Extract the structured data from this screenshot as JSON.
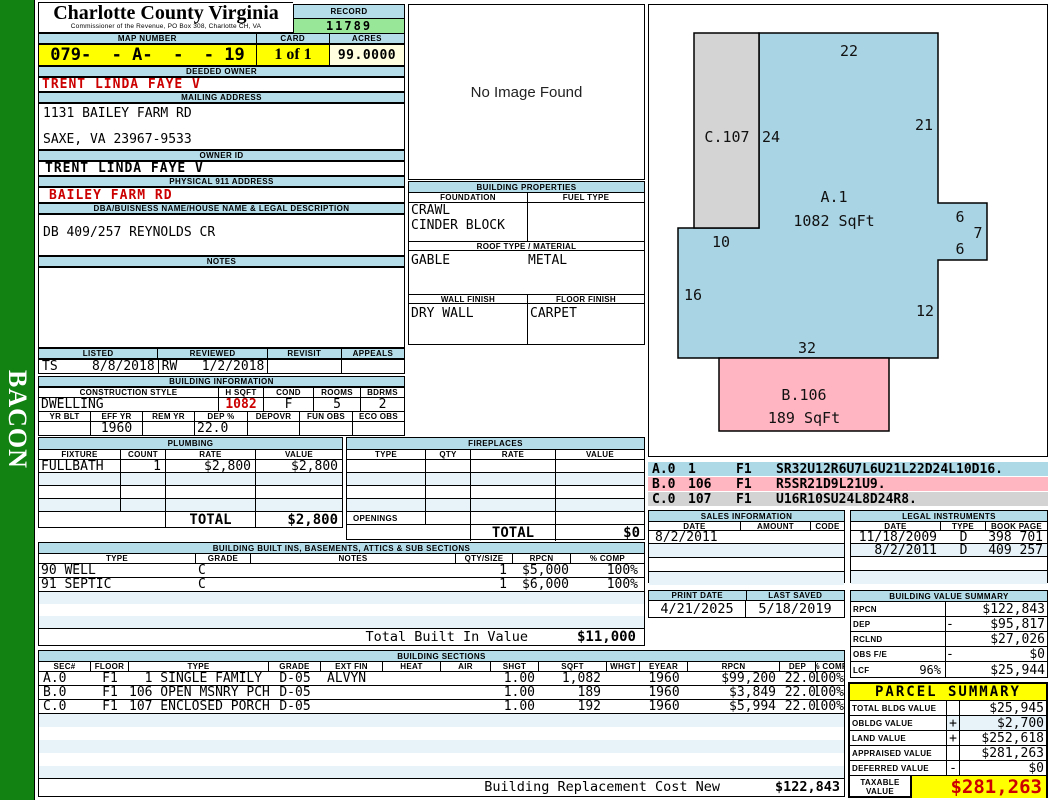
{
  "colors": {
    "header_bar": "#b5dde9",
    "highlight_yellow": "#ffff00",
    "record_green": "#98e798",
    "acres_cream": "#ffffe0",
    "alert_red": "#cc0000",
    "sidebar_green": "#128312",
    "sketch_blue": "#a9d4e4",
    "sketch_pink": "#ffb5c2",
    "sketch_gray": "#d4d4d4",
    "pale_row": "#e8f3f9"
  },
  "sidebar": {
    "label": "BACON"
  },
  "header": {
    "county": "Charlotte County Virginia",
    "subtitle": "Commissioner of the Revenue, PO Box 308, Charlotte CH, VA",
    "record_label": "RECORD",
    "record_number": "11789",
    "map_number_label": "MAP NUMBER",
    "map_number": "079-  - A-  -  - 19",
    "card_label": "CARD",
    "card": "1 of 1",
    "acres_label": "ACRES",
    "acres": "99.0000"
  },
  "owner": {
    "deeded_owner_label": "DEEDED OWNER",
    "deeded_owner": "TRENT LINDA FAYE V",
    "mailing_address_label": "MAILING ADDRESS",
    "mailing_line1": "1131 BAILEY FARM RD",
    "mailing_line2": "SAXE, VA 23967-9533",
    "owner_id_label": "OWNER ID",
    "owner_id": "TRENT LINDA FAYE V",
    "physical_label": "PHYSICAL 911 ADDRESS",
    "physical_address": "BAILEY FARM RD",
    "dba_label": "DBA/BUISNESS NAME/HOUSE NAME & LEGAL DESCRIPTION",
    "dba": "DB 409/257 REYNOLDS CR",
    "notes_label": "NOTES",
    "notes": ""
  },
  "review": {
    "listed_label": "LISTED",
    "listed_by": "TS",
    "listed_date": "8/8/2018",
    "reviewed_label": "REVIEWED",
    "reviewed_by": "RW",
    "reviewed_date": "1/2/2018",
    "revisit_label": "REVISIT",
    "revisit": "",
    "appeals_label": "APPEALS",
    "appeals": ""
  },
  "photo": {
    "placeholder": "No Image Found"
  },
  "building_properties": {
    "title": "BUILDING PROPERTIES",
    "foundation_label": "FOUNDATION",
    "fuel_label": "FUEL TYPE",
    "foundation_line1": "CRAWL",
    "foundation_line2": "CINDER BLOCK",
    "fuel": "",
    "roof_label": "ROOF TYPE / MATERIAL",
    "roof_type": "GABLE",
    "roof_material": "METAL",
    "wall_label": "WALL FINISH",
    "floor_label": "FLOOR FINISH",
    "wall_finish": "DRY WALL",
    "floor_finish": "CARPET"
  },
  "building_info": {
    "title": "BUILDING INFORMATION",
    "style_label": "CONSTRUCTION STYLE",
    "style": "DWELLING",
    "hsqft_label": "H SQFT",
    "hsqft": "1082",
    "cond_label": "COND",
    "cond": "F",
    "rooms_label": "ROOMS",
    "rooms": "5",
    "bdrms_label": "BDRMS",
    "bdrms": "2",
    "yrblt_label": "YR BLT",
    "yrblt": "",
    "effyr_label": "EFF YR",
    "effyr": "1960",
    "remyr_label": "REM YR",
    "remyr": "",
    "dep_label": "DEP %",
    "dep": "22.0",
    "depovr_label": "DEPOVR",
    "depovr": "",
    "funobs_label": "FUN OBS",
    "funobs": "",
    "ecoobs_label": "ECO OBS",
    "ecoobs": ""
  },
  "plumbing": {
    "title": "PLUMBING",
    "headers": [
      "FIXTURE",
      "COUNT",
      "RATE",
      "VALUE"
    ],
    "rows": [
      [
        "FULLBATH",
        "1",
        "$2,800",
        "$2,800"
      ]
    ],
    "total_label": "TOTAL",
    "total": "$2,800"
  },
  "fireplaces": {
    "title": "FIREPLACES",
    "headers": [
      "TYPE",
      "QTY",
      "RATE",
      "VALUE"
    ],
    "openings_label": "OPENINGS",
    "total_label": "TOTAL",
    "total": "$0"
  },
  "built_ins": {
    "title": "BUILDING BUILT INS, BASEMENTS, ATTICS & SUB SECTIONS",
    "headers": [
      "TYPE",
      "GRADE",
      "NOTES",
      "QTY/SIZE",
      "RPCN",
      "% COMP"
    ],
    "rows": [
      [
        "90 WELL",
        "C",
        "",
        "1",
        "$5,000",
        "100%"
      ],
      [
        "91 SEPTIC",
        "C",
        "",
        "1",
        "$6,000",
        "100%"
      ]
    ],
    "total_label": "Total Built In Value",
    "total": "$11,000"
  },
  "sketch": {
    "legend": [
      {
        "sec": "A.0",
        "code": "1",
        "floor": "F1",
        "vector": "SR32U12R6U7L6U21L22D24L10D16."
      },
      {
        "sec": "B.0",
        "code": "106",
        "floor": "F1",
        "vector": "R5SR21D9L21U9."
      },
      {
        "sec": "C.0",
        "code": "107",
        "floor": "F1",
        "vector": "U16R10SU24L8D24R8."
      }
    ],
    "labels": {
      "area_a": "A.1",
      "area_a_sqft": "1082 SqFt",
      "area_b": "B.106",
      "area_b_sqft": "189 SqFt",
      "area_c": "C.107",
      "dim_top": "22",
      "dim_right": "21",
      "dim_24": "24",
      "dim_6a": "6",
      "dim_7": "7",
      "dim_6b": "6",
      "dim_10": "10",
      "dim_16": "16",
      "dim_12": "12",
      "dim_32": "32"
    }
  },
  "sales": {
    "title": "SALES INFORMATION",
    "headers": [
      "DATE",
      "AMOUNT",
      "CODE"
    ],
    "rows": [
      [
        "8/2/2011",
        "",
        ""
      ]
    ]
  },
  "legal": {
    "title": "LEGAL INSTRUMENTS",
    "headers": [
      "DATE",
      "TYPE",
      "BOOK PAGE"
    ],
    "rows": [
      [
        "11/18/2009",
        "D",
        "398 701"
      ],
      [
        "8/2/2011",
        "D",
        "409 257"
      ]
    ]
  },
  "print_info": {
    "print_date_label": "PRINT DATE",
    "print_date": "4/21/2025",
    "last_saved_label": "LAST SAVED",
    "last_saved": "5/18/2019"
  },
  "value_summary": {
    "title": "BUILDING VALUE SUMMARY",
    "rows": [
      {
        "label": "RPCN",
        "op": "",
        "value": "$122,843"
      },
      {
        "label": "DEP",
        "op": "-",
        "value": "$95,817"
      },
      {
        "label": "RCLND",
        "op": "",
        "value": "$27,026"
      },
      {
        "label": "OBS F/E",
        "op": "-",
        "value": "$0"
      },
      {
        "label": "LCF",
        "pct": "96%",
        "op": "",
        "value": "$25,944"
      }
    ]
  },
  "building_sections": {
    "title": "BUILDING SECTIONS",
    "headers": [
      "SEC#",
      "FLOOR",
      "TYPE",
      "GRADE",
      "EXT FIN",
      "HEAT",
      "AIR",
      "SHGT",
      "SQFT",
      "WHGT",
      "EYEAR",
      "RPCN",
      "DEP",
      "% COMP"
    ],
    "rows": [
      [
        "A.0",
        "F1",
        "  1 SINGLE FAMILY",
        "D-05",
        "ALVYN",
        "",
        "",
        "1.00",
        "1,082",
        "",
        "1960",
        "$99,200",
        "22.0",
        "100%"
      ],
      [
        "B.0",
        "F1",
        "106 OPEN MSNRY PCH",
        "D-05",
        "",
        "",
        "",
        "1.00",
        "189",
        "",
        "1960",
        "$3,849",
        "22.0",
        "100%"
      ],
      [
        "C.0",
        "F1",
        "107 ENCLOSED PORCH",
        "D-05",
        "",
        "",
        "",
        "1.00",
        "192",
        "",
        "1960",
        "$5,994",
        "22.0",
        "100%"
      ]
    ],
    "footer_label": "Building Replacement Cost New",
    "footer_value": "$122,843"
  },
  "parcel_summary": {
    "title": "PARCEL SUMMARY",
    "rows": [
      {
        "label": "TOTAL BLDG VALUE",
        "op": "",
        "value": "$25,945"
      },
      {
        "label": "OBLDG VALUE",
        "op": "+",
        "value": "$2,700"
      },
      {
        "label": "LAND VALUE",
        "op": "+",
        "value": "$252,618"
      },
      {
        "label": "APPRAISED VALUE",
        "op": "",
        "value": "$281,263"
      },
      {
        "label": "DEFERRED VALUE",
        "op": "-",
        "value": "$0"
      }
    ],
    "taxable_label": "TAXABLE VALUE",
    "taxable_value": "$281,263"
  }
}
